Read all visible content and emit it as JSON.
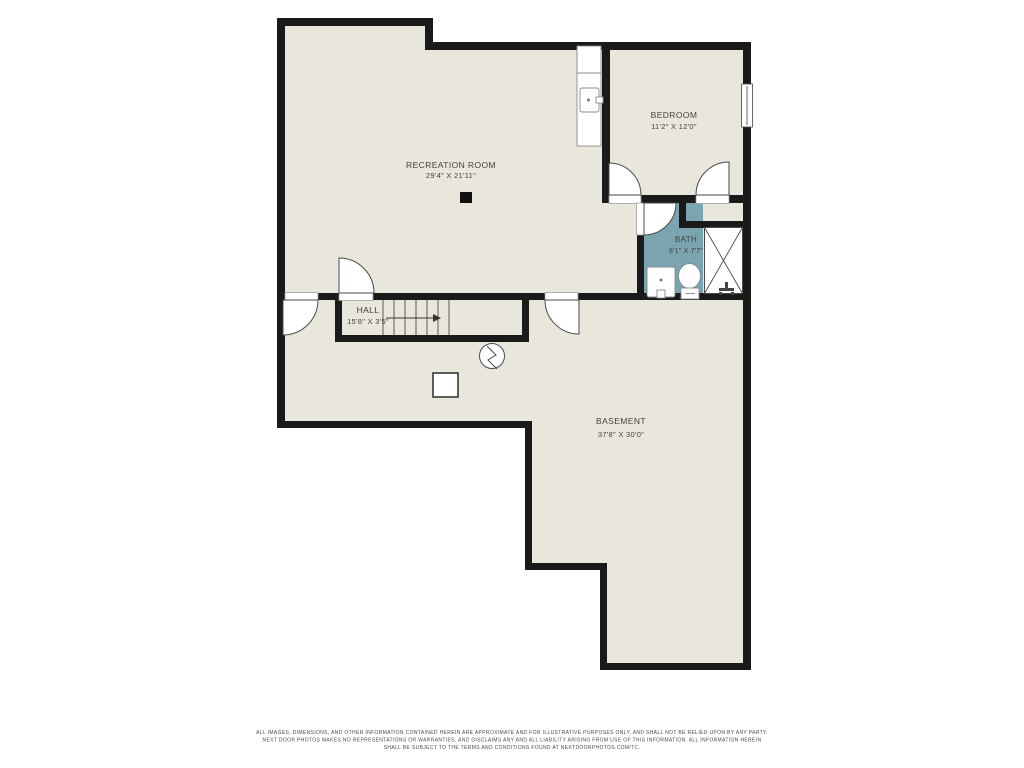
{
  "floorplan": {
    "rooms": {
      "recreation": {
        "name": "RECREATION ROOM",
        "dims": "29'4\" X 21'11\""
      },
      "bedroom": {
        "name": "BEDROOM",
        "dims": "11'2\" X 12'0\""
      },
      "bath": {
        "name": "BATH",
        "dims": "8'1\" X 7'7\""
      },
      "hall": {
        "name": "HALL",
        "dims": "15'8\" X 3'5\""
      },
      "basement": {
        "name": "BASEMENT",
        "dims": "37'8\" X 30'0\""
      }
    },
    "colors": {
      "floor": "#e9e7dc",
      "bath_floor": "#7aa5b0",
      "wall": "#1a1a1a",
      "label": "#3f3f3f"
    },
    "disclaimer": {
      "line1": "ALL IMAGES, DIMENSIONS, AND OTHER INFORMATION CONTAINED HEREIN ARE APPROXIMATE AND FOR ILLUSTRATIVE PURPOSES ONLY, AND SHALL NOT BE RELIED UPON BY ANY PARTY.",
      "line2": "NEXT DOOR PHOTOS MAKES NO REPRESENTATIONS OR WARRANTIES, AND DISCLAIMS ANY AND ALL LIABILITY ARISING FROM USE OF THIS INFORMATION. ALL INFORMATION HEREIN",
      "line3": "SHALL BE SUBJECT TO THE TERMS AND CONDITIONS FOUND AT NEXTDOORPHOTOS.COM/TC."
    }
  }
}
